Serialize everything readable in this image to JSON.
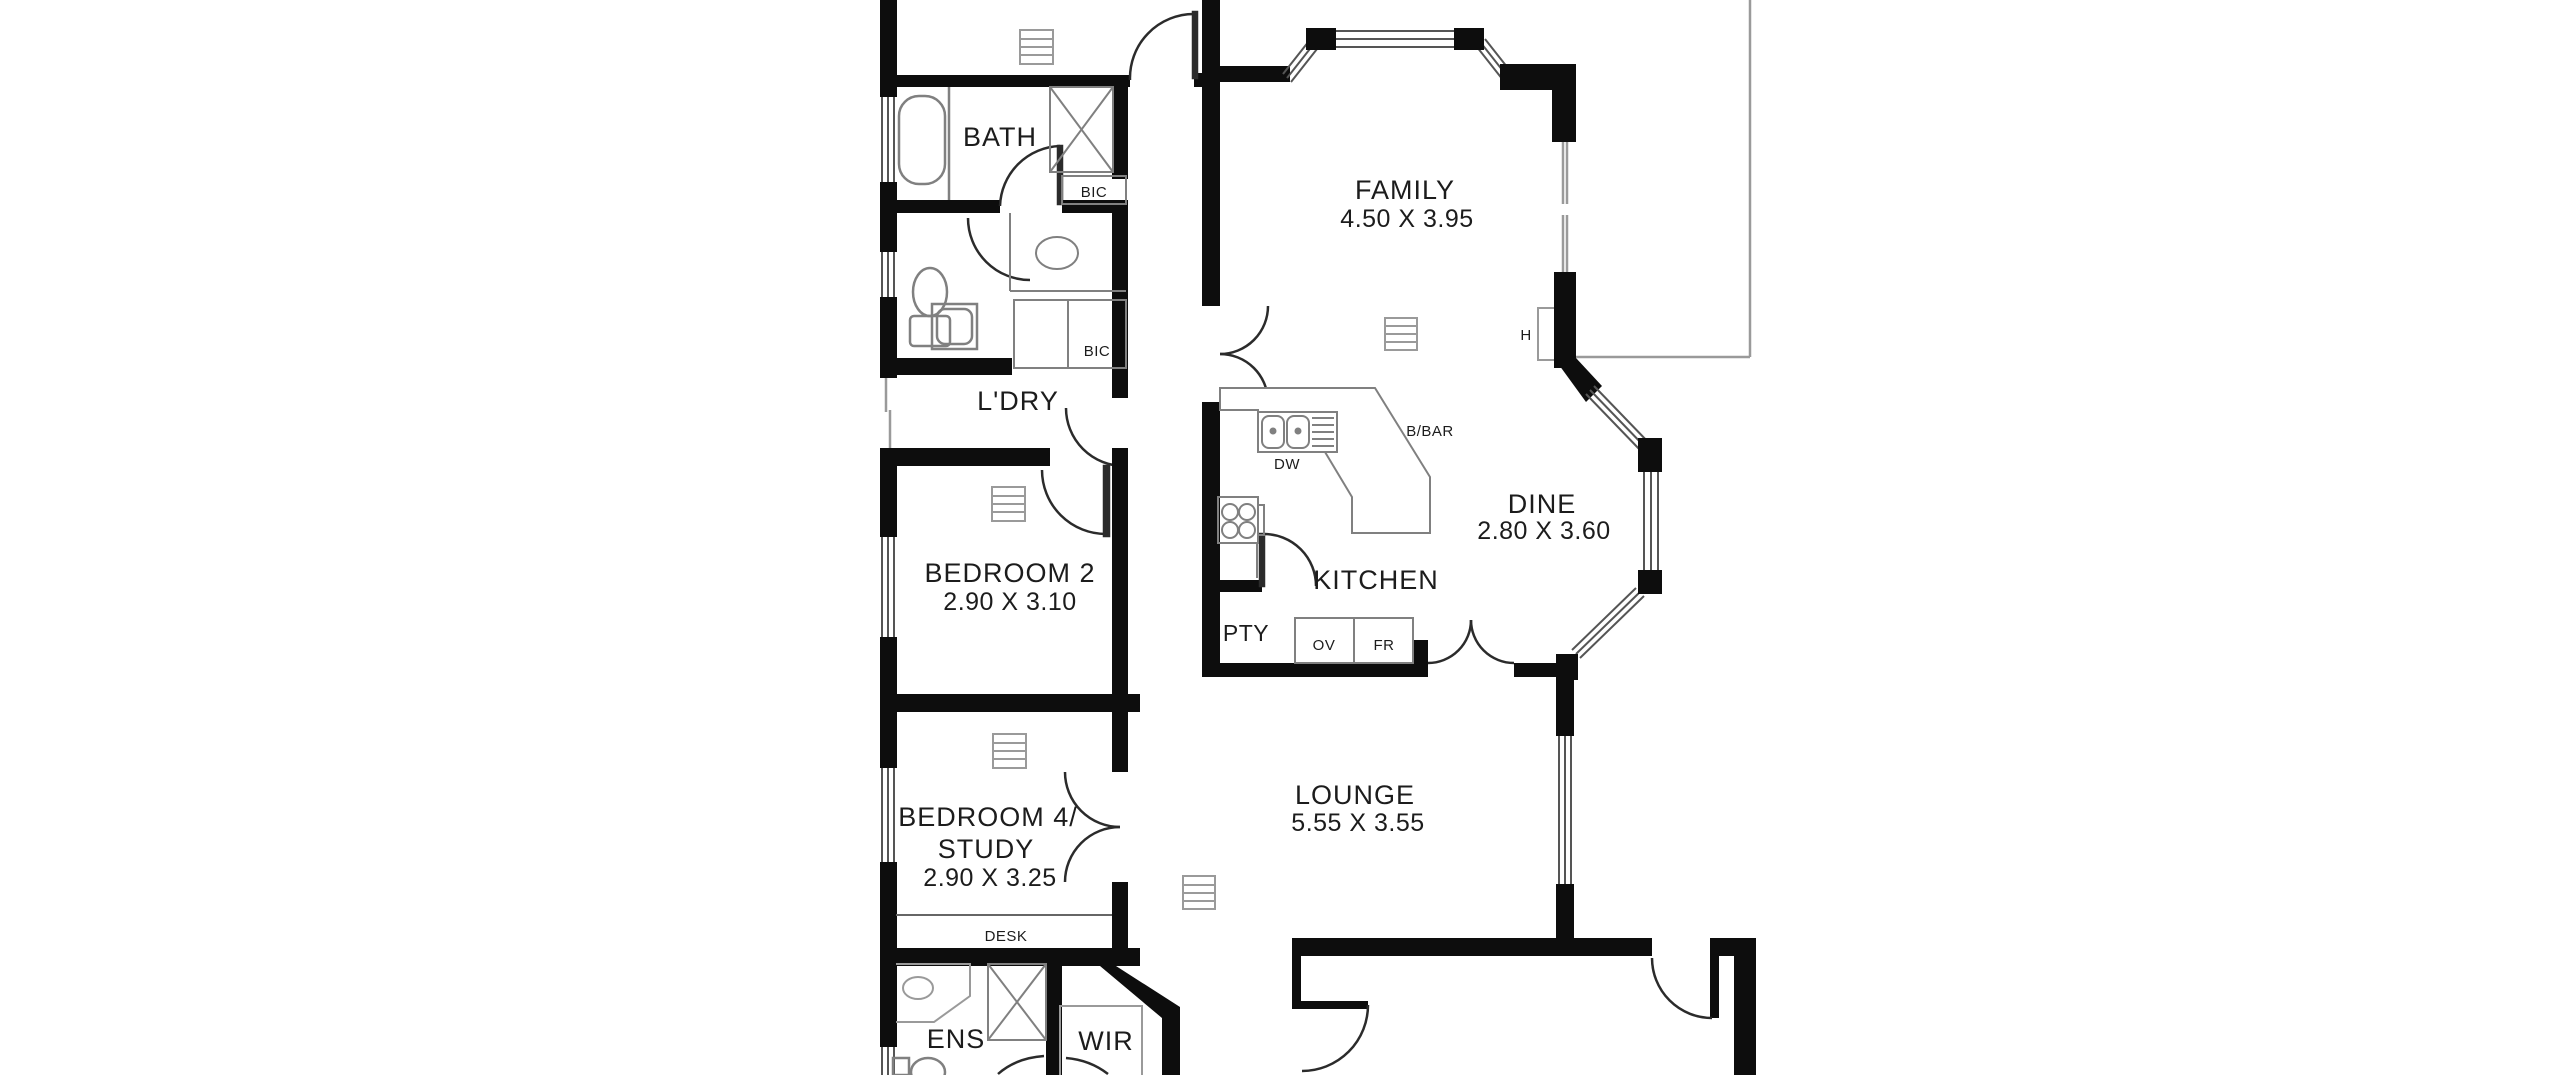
{
  "floorplan": {
    "rooms": {
      "family": {
        "label": "FAMILY",
        "dims": "4.50 X 3.95"
      },
      "dine": {
        "label": "DINE",
        "dims": "2.80 X 3.60"
      },
      "kitchen": {
        "label": "KITCHEN"
      },
      "lounge": {
        "label": "LOUNGE",
        "dims": "5.55 X 3.55"
      },
      "bath": {
        "label": "BATH"
      },
      "laundry": {
        "label": "L'DRY"
      },
      "bedroom2": {
        "label": "BEDROOM 2",
        "dims": "2.90 X 3.10"
      },
      "bedroom4": {
        "label": "BEDROOM 4/",
        "label2": "STUDY",
        "dims": "2.90 X 3.25"
      },
      "pantry": {
        "label": "PTY"
      },
      "ensuite": {
        "label": "ENS"
      },
      "wir": {
        "label": "WIR"
      }
    },
    "fixtures": {
      "bic": "BIC",
      "dw": "DW",
      "bbar": "B/BAR",
      "ov": "OV",
      "fr": "FR",
      "desk": "DESK",
      "hot_water": "H"
    },
    "colors": {
      "wall": "#0d0d0d",
      "fixture_line": "#808080",
      "faint_outline": "#9a9a9a",
      "text": "#1c1c1c",
      "background": "#ffffff"
    }
  }
}
